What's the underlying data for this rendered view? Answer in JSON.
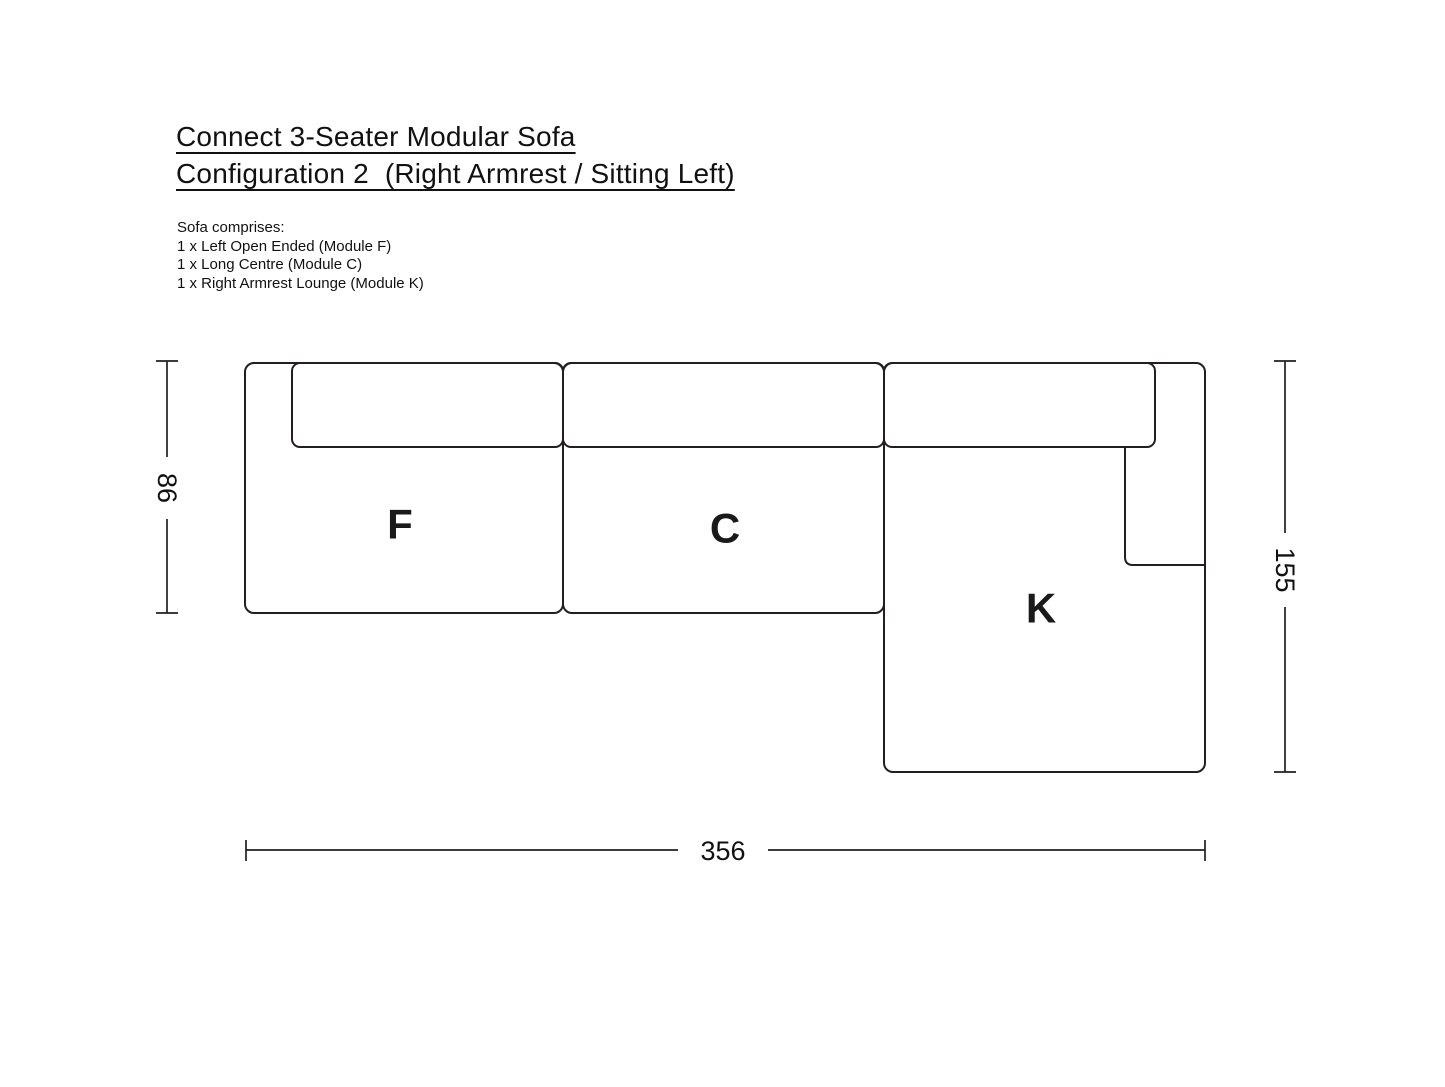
{
  "title": {
    "line1": "Connect 3-Seater Modular Sofa",
    "line2": "Configuration 2  (Right Armrest / Sitting Left)"
  },
  "description": {
    "intro": "Sofa comprises:",
    "items": [
      "1 x Left Open Ended (Module F)",
      "1 x Long Centre (Module C)",
      "1 x Right Armrest Lounge (Module K)"
    ]
  },
  "modules": [
    {
      "label": "F",
      "name": "Left Open Ended"
    },
    {
      "label": "C",
      "name": "Long Centre"
    },
    {
      "label": "K",
      "name": "Right Armrest Lounge"
    }
  ],
  "dimensions": {
    "depth": "86",
    "lounge_depth": "155",
    "width": "356"
  },
  "colors": {
    "line": "#231f20",
    "text": "#111111",
    "background": "#ffffff"
  }
}
